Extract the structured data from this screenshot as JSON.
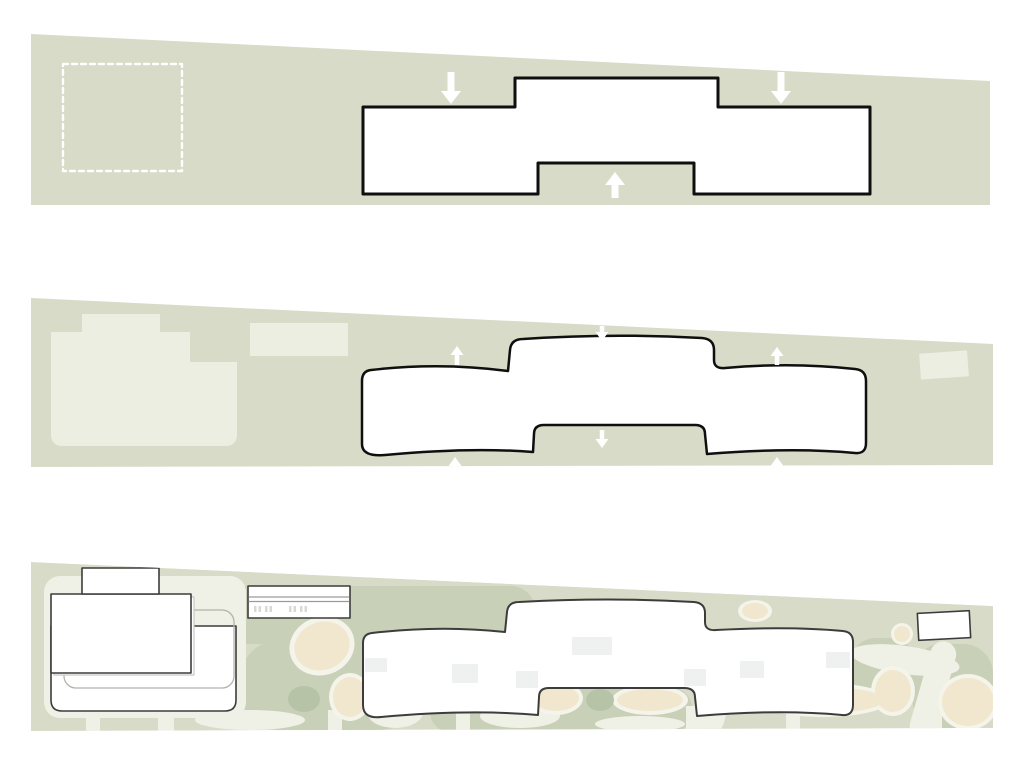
{
  "canvas": {
    "width": 1024,
    "height": 768,
    "background": "#ffffff"
  },
  "colors": {
    "pageBg": "#ffffff",
    "site": "#d7dbc7",
    "mass": "#edeee2",
    "pathLight": "#f0f1e6",
    "halo": "#f4f4ea",
    "patch": "#c8d0b8",
    "patchDark": "#b7c3a6",
    "beige": "#f1e7cf",
    "ink": "#0f0f0f",
    "inkSoft": "#3c3c3c",
    "grayLine": "#b2b2ae",
    "ghost": "#c7c7c3",
    "parkLine": "#9b9b97",
    "tick": "#dadad4",
    "roof": "#eef1f0",
    "white": "#ffffff",
    "arrow": "#ffffff"
  },
  "panels": [
    {
      "name": "top-massing-diagram",
      "shapes": [
        {
          "name": "site-band",
          "type": "polygon",
          "points": "31,34 990,81 990,205 31,205",
          "fill": "site"
        },
        {
          "name": "footprint-dashed-outline",
          "type": "rect",
          "x": 63,
          "y": 64,
          "w": 119,
          "h": 107,
          "stroke": "white",
          "sw": 2.4,
          "dash": "5,4"
        },
        {
          "name": "building-footprint",
          "type": "path",
          "d": "M 363,107 L 515,107 L 515,78 L 718,78 L 718,107 L 870,107 L 870,194 L 694,194 L 694,163 L 538,163 L 538,194 L 363,194 Z",
          "fill": "white",
          "stroke": "ink",
          "sw": 3
        },
        {
          "name": "pressure-arrow-down-left",
          "type": "arrow",
          "x": 451,
          "tipY": 104,
          "dir": "down",
          "len": 32,
          "headW": 20,
          "headL": 13,
          "shaftW": 7,
          "fill": "arrow"
        },
        {
          "name": "pressure-arrow-down-right",
          "type": "arrow",
          "x": 781,
          "tipY": 104,
          "dir": "down",
          "len": 32,
          "headW": 20,
          "headL": 13,
          "shaftW": 7,
          "fill": "arrow"
        },
        {
          "name": "pressure-arrow-up-center",
          "type": "arrow",
          "x": 615,
          "tipY": 172,
          "dir": "up",
          "len": 26,
          "headW": 20,
          "headL": 13,
          "shaftW": 7,
          "fill": "arrow"
        }
      ]
    },
    {
      "name": "middle-massing-diagram",
      "shapes": [
        {
          "name": "site-band",
          "type": "polygon",
          "points": "31,298 993,344 993,465 31,467",
          "fill": "site"
        },
        {
          "name": "existing-building-mass",
          "type": "path",
          "d": "M 51,332 L 82,332 L 82,314 L 160,314 L 160,332 L 190,332 L 190,362 L 237,362 L 237,434 Q 237,446 225,446 L 63,446 Q 51,446 51,434 Z",
          "fill": "mass"
        },
        {
          "name": "neighbor-mass-center",
          "type": "rect",
          "x": 250,
          "y": 323,
          "w": 98,
          "h": 33,
          "fill": "mass"
        },
        {
          "name": "neighbor-mass-right",
          "type": "rect",
          "x": 920,
          "y": 352,
          "w": 48,
          "h": 26,
          "rot": -4,
          "fill": "mass"
        },
        {
          "name": "building-outline",
          "type": "path",
          "d": "M 371,370 Q 440,362 508,371 L 510,350 Q 511,339 523,339 Q 612,333 702,338 Q 714,339 714,350 L 714,360 Q 714,369 725,368 Q 792,362 855,369 Q 866,370 866,381 L 866,443 Q 866,454 855,453 Q 792,447 707,454 L 705,434 Q 705,425 695,425 L 544,425 Q 534,425 534,434 L 533,452 Q 470,447 385,455 Q 362,457 362,444 L 362,381 Q 362,371 371,370 Z",
          "fill": "white",
          "stroke": "ink",
          "sw": 2.5
        },
        {
          "name": "flow-arrow-up-top-left",
          "type": "arrow",
          "x": 457,
          "tipY": 346,
          "dir": "up",
          "len": 19,
          "headW": 13,
          "headL": 9,
          "shaftW": 4.5,
          "fill": "arrow"
        },
        {
          "name": "flow-arrow-down-top-center",
          "type": "arrow",
          "x": 602,
          "tipY": 341,
          "dir": "down",
          "len": 15,
          "headW": 13,
          "headL": 9,
          "shaftW": 4.5,
          "fill": "arrow"
        },
        {
          "name": "flow-arrow-up-top-right",
          "type": "arrow",
          "x": 777,
          "tipY": 347,
          "dir": "up",
          "len": 18,
          "headW": 13,
          "headL": 9,
          "shaftW": 4.5,
          "fill": "arrow"
        },
        {
          "name": "flow-arrow-up-bottom-left",
          "type": "arrow",
          "x": 455,
          "tipY": 457,
          "dir": "up",
          "len": 17,
          "headW": 13,
          "headL": 9,
          "shaftW": 4.5,
          "fill": "arrow"
        },
        {
          "name": "flow-arrow-down-notch",
          "type": "arrow",
          "x": 602,
          "tipY": 448,
          "dir": "down",
          "len": 18,
          "headW": 13,
          "headL": 9,
          "shaftW": 4.5,
          "fill": "arrow"
        },
        {
          "name": "flow-arrow-up-bottom-right",
          "type": "arrow",
          "x": 777,
          "tipY": 457,
          "dir": "up",
          "len": 17,
          "headW": 13,
          "headL": 9,
          "shaftW": 4.5,
          "fill": "arrow"
        }
      ]
    },
    {
      "name": "bottom-site-plan",
      "clip": "31,562 993,606 993,728 31,731",
      "shapes": [
        {
          "name": "site-band",
          "type": "polygon",
          "points": "31,562 993,606 993,728 31,731",
          "fill": "site"
        },
        {
          "name": "lawn-patch-1",
          "type": "rect",
          "x": 163,
          "y": 586,
          "w": 372,
          "h": 58,
          "rx": 24,
          "fill": "patch"
        },
        {
          "name": "lawn-patch-2",
          "type": "rect",
          "x": 240,
          "y": 640,
          "w": 180,
          "h": 90,
          "rx": 40,
          "fill": "patch"
        },
        {
          "name": "lawn-patch-3",
          "type": "rect",
          "x": 430,
          "y": 688,
          "w": 262,
          "h": 44,
          "rx": 20,
          "fill": "patch"
        },
        {
          "name": "lawn-patch-4",
          "type": "rect",
          "x": 850,
          "y": 638,
          "w": 66,
          "h": 58,
          "rx": 26,
          "fill": "patch"
        },
        {
          "name": "lawn-patch-5",
          "type": "rect",
          "x": 912,
          "y": 644,
          "w": 81,
          "h": 84,
          "rx": 30,
          "fill": "patch"
        },
        {
          "name": "paved-pad",
          "type": "rect",
          "x": 44,
          "y": 576,
          "w": 202,
          "h": 142,
          "rx": 16,
          "fill": "pathLight"
        },
        {
          "name": "path-slit-1",
          "type": "rect",
          "x": 86,
          "y": 714,
          "w": 14,
          "h": 18,
          "fill": "pathLight"
        },
        {
          "name": "path-slit-2",
          "type": "rect",
          "x": 158,
          "y": 714,
          "w": 16,
          "h": 18,
          "fill": "pathLight"
        },
        {
          "name": "path-slit-3",
          "type": "rect",
          "x": 328,
          "y": 710,
          "w": 14,
          "h": 22,
          "fill": "pathLight"
        },
        {
          "name": "path-slit-4",
          "type": "rect",
          "x": 456,
          "y": 710,
          "w": 14,
          "h": 22,
          "fill": "pathLight"
        },
        {
          "name": "path-slit-5",
          "type": "rect",
          "x": 686,
          "y": 706,
          "w": 16,
          "h": 26,
          "fill": "pathLight"
        },
        {
          "name": "path-slit-6",
          "type": "rect",
          "x": 786,
          "y": 710,
          "w": 14,
          "h": 22,
          "fill": "pathLight"
        },
        {
          "name": "path-slit-7",
          "type": "rect",
          "x": 926,
          "y": 694,
          "w": 16,
          "h": 38,
          "fill": "pathLight"
        },
        {
          "name": "winding-path-1",
          "type": "ellipse",
          "cx": 250,
          "cy": 720,
          "rx": 55,
          "ry": 10,
          "fill": "pathLight"
        },
        {
          "name": "winding-path-2",
          "type": "ellipse",
          "cx": 395,
          "cy": 712,
          "rx": 28,
          "ry": 16,
          "fill": "pathLight"
        },
        {
          "name": "winding-path-3",
          "type": "ellipse",
          "cx": 520,
          "cy": 716,
          "rx": 40,
          "ry": 12,
          "fill": "pathLight"
        },
        {
          "name": "winding-path-4",
          "type": "ellipse",
          "cx": 640,
          "cy": 724,
          "rx": 45,
          "ry": 8,
          "fill": "pathLight"
        },
        {
          "name": "winding-path-5",
          "type": "ellipse",
          "cx": 710,
          "cy": 710,
          "rx": 16,
          "ry": 26,
          "fill": "pathLight"
        },
        {
          "name": "winding-path-6",
          "type": "rect",
          "x": 920,
          "y": 640,
          "w": 26,
          "h": 100,
          "rx": 13,
          "rot": 16,
          "fill": "pathLight"
        },
        {
          "name": "winding-path-7",
          "type": "ellipse",
          "cx": 905,
          "cy": 660,
          "rx": 55,
          "ry": 14,
          "rot": 8,
          "fill": "pathLight"
        },
        {
          "name": "planting-halo-1",
          "type": "ellipse",
          "cx": 322,
          "cy": 646,
          "rx": 33,
          "ry": 29,
          "rot": -20,
          "fill": "halo"
        },
        {
          "name": "planting-halo-2",
          "type": "ellipse",
          "cx": 350,
          "cy": 697,
          "rx": 21,
          "ry": 24,
          "fill": "halo"
        },
        {
          "name": "planting-halo-3",
          "type": "ellipse",
          "cx": 556,
          "cy": 698,
          "rx": 27,
          "ry": 17,
          "fill": "halo"
        },
        {
          "name": "planting-halo-4",
          "type": "ellipse",
          "cx": 650,
          "cy": 700,
          "rx": 38,
          "ry": 15,
          "fill": "halo"
        },
        {
          "name": "planting-halo-5",
          "type": "ellipse",
          "cx": 823,
          "cy": 700,
          "rx": 67,
          "ry": 17,
          "fill": "halo"
        },
        {
          "name": "planting-halo-6",
          "type": "ellipse",
          "cx": 755,
          "cy": 611,
          "rx": 17,
          "ry": 11,
          "fill": "halo"
        },
        {
          "name": "planting-halo-7",
          "type": "ellipse",
          "cx": 902,
          "cy": 634,
          "rx": 11,
          "ry": 11,
          "fill": "halo"
        },
        {
          "name": "planting-halo-8",
          "type": "ellipse",
          "cx": 893,
          "cy": 691,
          "rx": 22,
          "ry": 25,
          "fill": "halo"
        },
        {
          "name": "planting-halo-9",
          "type": "ellipse",
          "cx": 968,
          "cy": 702,
          "rx": 30,
          "ry": 28,
          "fill": "halo"
        },
        {
          "name": "planting-bed-1",
          "type": "ellipse",
          "cx": 322,
          "cy": 646,
          "rx": 28,
          "ry": 24,
          "rot": -20,
          "fill": "beige"
        },
        {
          "name": "planting-bed-2",
          "type": "ellipse",
          "cx": 350,
          "cy": 697,
          "rx": 17,
          "ry": 20,
          "fill": "beige"
        },
        {
          "name": "planting-bed-3",
          "type": "ellipse",
          "cx": 556,
          "cy": 698,
          "rx": 23,
          "ry": 13,
          "fill": "beige"
        },
        {
          "name": "planting-bed-4",
          "type": "ellipse",
          "cx": 650,
          "cy": 700,
          "rx": 33,
          "ry": 11,
          "fill": "beige"
        },
        {
          "name": "planting-bed-5",
          "type": "ellipse",
          "cx": 823,
          "cy": 700,
          "rx": 62,
          "ry": 13,
          "fill": "beige"
        },
        {
          "name": "planting-bed-6",
          "type": "ellipse",
          "cx": 755,
          "cy": 611,
          "rx": 13,
          "ry": 8,
          "fill": "beige"
        },
        {
          "name": "planting-bed-7",
          "type": "ellipse",
          "cx": 902,
          "cy": 634,
          "rx": 8,
          "ry": 8,
          "fill": "beige"
        },
        {
          "name": "planting-bed-8",
          "type": "ellipse",
          "cx": 893,
          "cy": 691,
          "rx": 18,
          "ry": 21,
          "fill": "beige"
        },
        {
          "name": "planting-bed-9",
          "type": "ellipse",
          "cx": 968,
          "cy": 702,
          "rx": 26,
          "ry": 24,
          "fill": "beige"
        },
        {
          "name": "shrub-blob-1",
          "type": "ellipse",
          "cx": 600,
          "cy": 700,
          "rx": 14,
          "ry": 11,
          "fill": "patchDark"
        },
        {
          "name": "shrub-blob-2",
          "type": "ellipse",
          "cx": 304,
          "cy": 699,
          "rx": 16,
          "ry": 13,
          "fill": "patchDark"
        },
        {
          "name": "existing-building-base",
          "type": "path",
          "d": "M 51,626 L 236,626 L 236,700 Q 236,711 225,711 L 62,711 Q 51,711 51,700 Z",
          "fill": "white",
          "stroke": "inkSoft",
          "sw": 1.6
        },
        {
          "name": "existing-building-inset-outline",
          "type": "rect",
          "x": 64,
          "y": 610,
          "w": 170,
          "h": 78,
          "rx": 12,
          "stroke": "grayLine",
          "sw": 1.3
        },
        {
          "name": "existing-building-ghost-plate",
          "type": "rect",
          "x": 54,
          "y": 597,
          "w": 140,
          "h": 78,
          "fill": "white",
          "stroke": "ghost",
          "sw": 1.2
        },
        {
          "name": "existing-building-upper",
          "type": "rect",
          "x": 51,
          "y": 594,
          "w": 140,
          "h": 79,
          "fill": "white",
          "stroke": "inkSoft",
          "sw": 1.6
        },
        {
          "name": "existing-building-rooftop",
          "type": "rect",
          "x": 82,
          "y": 568,
          "w": 77,
          "h": 26,
          "fill": "white",
          "stroke": "inkSoft",
          "sw": 1.6
        },
        {
          "name": "parking-structure",
          "type": "rect",
          "x": 248,
          "y": 586,
          "w": 102,
          "h": 32,
          "fill": "white",
          "stroke": "inkSoft",
          "sw": 1.6
        },
        {
          "name": "parking-lane-line-1",
          "type": "line",
          "x1": 249,
          "y1": 597,
          "x2": 349,
          "y2": 597,
          "stroke": "parkLine",
          "sw": 1.2
        },
        {
          "name": "parking-lane-line-2",
          "type": "line",
          "x1": 249,
          "y1": 601.5,
          "x2": 349,
          "y2": 601.5,
          "stroke": "parkLine",
          "sw": 1.2
        },
        {
          "name": "parking-stall-tick-1",
          "type": "rect",
          "x": 254,
          "y": 606,
          "w": 2.5,
          "h": 6,
          "fill": "tick"
        },
        {
          "name": "parking-stall-tick-2",
          "type": "rect",
          "x": 258.5,
          "y": 606,
          "w": 2.5,
          "h": 6,
          "fill": "tick"
        },
        {
          "name": "parking-stall-tick-3",
          "type": "rect",
          "x": 265,
          "y": 606,
          "w": 2.5,
          "h": 6,
          "fill": "tick"
        },
        {
          "name": "parking-stall-tick-4",
          "type": "rect",
          "x": 269.5,
          "y": 606,
          "w": 2.5,
          "h": 6,
          "fill": "tick"
        },
        {
          "name": "parking-stall-tick-5",
          "type": "rect",
          "x": 289,
          "y": 606,
          "w": 2.5,
          "h": 6,
          "fill": "tick"
        },
        {
          "name": "parking-stall-tick-6",
          "type": "rect",
          "x": 293.5,
          "y": 606,
          "w": 2.5,
          "h": 6,
          "fill": "tick"
        },
        {
          "name": "parking-stall-tick-7",
          "type": "rect",
          "x": 300,
          "y": 606,
          "w": 2.5,
          "h": 6,
          "fill": "tick"
        },
        {
          "name": "parking-stall-tick-8",
          "type": "rect",
          "x": 304.5,
          "y": 606,
          "w": 2.5,
          "h": 6,
          "fill": "tick"
        },
        {
          "name": "main-building-footprint",
          "type": "path",
          "d": "M 372,633 Q 440,625 505,632 L 507,612 Q 508,602 519,602 Q 610,597 694,602 Q 705,603 705,613 L 705,622 Q 705,631 716,630 Q 790,626 843,631 Q 853,632 853,642 L 853,705 Q 853,716 842,715 Q 780,709 697,716 L 695,697 Q 695,688 684,688 L 549,688 Q 539,688 539,697 L 538,715 Q 470,709 381,717 Q 363,719 363,705 L 363,643 Q 363,634 372,633 Z",
          "fill": "white",
          "stroke": "inkSoft",
          "sw": 2
        },
        {
          "name": "roof-element-1",
          "type": "rect",
          "x": 572,
          "y": 637,
          "w": 40,
          "h": 18,
          "fill": "roof"
        },
        {
          "name": "roof-element-2",
          "type": "rect",
          "x": 365,
          "y": 658,
          "w": 22,
          "h": 14,
          "fill": "roof"
        },
        {
          "name": "roof-element-3",
          "type": "rect",
          "x": 452,
          "y": 664,
          "w": 26,
          "h": 19,
          "fill": "roof"
        },
        {
          "name": "roof-element-4",
          "type": "rect",
          "x": 516,
          "y": 671,
          "w": 22,
          "h": 17,
          "fill": "roof"
        },
        {
          "name": "roof-element-5",
          "type": "rect",
          "x": 684,
          "y": 669,
          "w": 22,
          "h": 17,
          "fill": "roof"
        },
        {
          "name": "roof-element-6",
          "type": "rect",
          "x": 740,
          "y": 661,
          "w": 24,
          "h": 17,
          "fill": "roof"
        },
        {
          "name": "roof-element-7",
          "type": "rect",
          "x": 826,
          "y": 652,
          "w": 24,
          "h": 16,
          "fill": "roof"
        },
        {
          "name": "small-outbuilding",
          "type": "rect",
          "x": 918,
          "y": 612,
          "w": 52,
          "h": 27,
          "rot": -3,
          "fill": "white",
          "stroke": "inkSoft",
          "sw": 1.6
        }
      ]
    }
  ]
}
